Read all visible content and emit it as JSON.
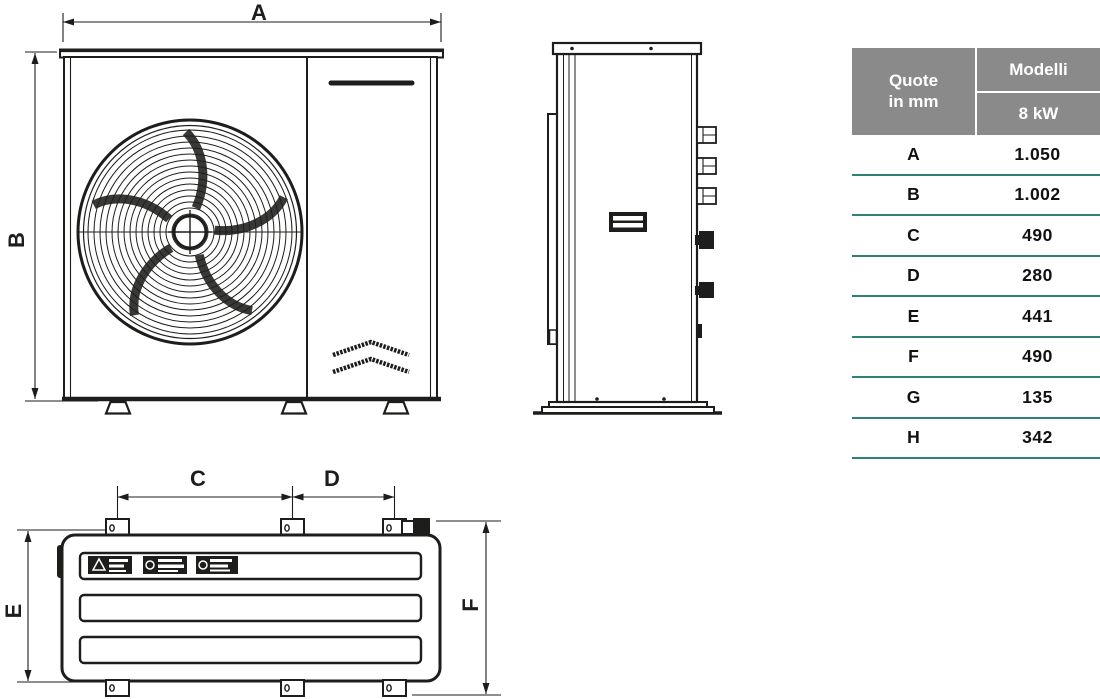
{
  "dimension_table": {
    "header": {
      "quote_line1": "Quote",
      "quote_line2": "in mm",
      "models_title": "Modelli",
      "model_name": "8 kW"
    },
    "rows": [
      {
        "label": "A",
        "value": "1.050"
      },
      {
        "label": "B",
        "value": "1.002"
      },
      {
        "label": "C",
        "value": "490"
      },
      {
        "label": "D",
        "value": "280"
      },
      {
        "label": "E",
        "value": "441"
      },
      {
        "label": "F",
        "value": "490"
      },
      {
        "label": "G",
        "value": "135"
      },
      {
        "label": "H",
        "value": "342"
      }
    ]
  },
  "diagrams": {
    "front_view": {
      "dim_width": "A",
      "dim_height": "B"
    },
    "bottom_view": {
      "dim_c": "C",
      "dim_d": "D",
      "dim_e": "E",
      "dim_f": "F"
    }
  },
  "colors": {
    "line": "#1d1d1b",
    "table_header_bg": "#8a8a8a",
    "table_divider": "#2f8177"
  }
}
